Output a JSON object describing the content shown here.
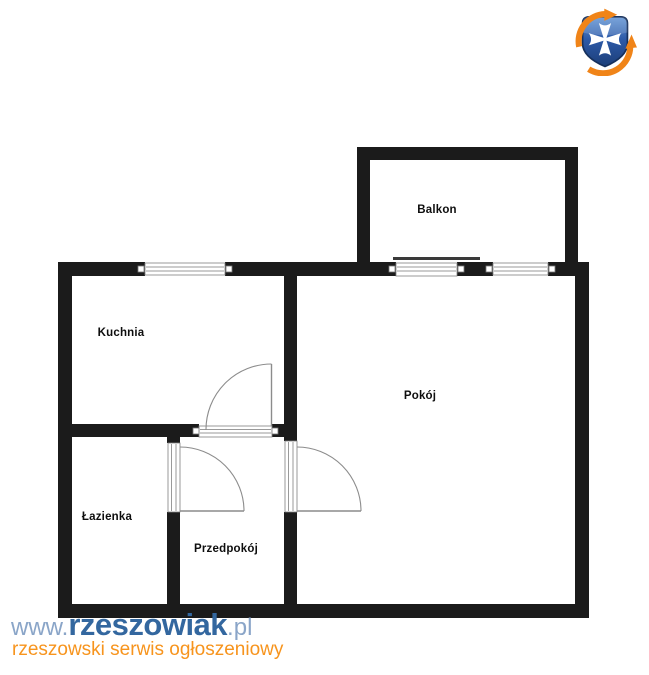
{
  "page": {
    "background": "#ffffff"
  },
  "branding": {
    "logo_icon": "rzeszowiak-shield-cross-logo",
    "watermark": {
      "prefix": "www.",
      "brand": "rzeszowiak",
      "suffix": ".pl",
      "tagline": "rzeszowski serwis ogłoszeniowy"
    },
    "colors": {
      "brand_blue": "#33679f",
      "muted_blue": "#8aa5c8",
      "tagline_orange": "#f7941d",
      "logo_navy": "#1c3e78",
      "logo_orange": "#f08418"
    }
  },
  "floorplan": {
    "type": "apartment-floor-plan",
    "wall_color": "#1b1b1b",
    "labels": {
      "balkon": "Balkon",
      "kuchnia": "Kuchnia",
      "pokoj": "Pokój",
      "lazienka": "Łazienka",
      "przedpokoj": "Przedpokój"
    }
  }
}
